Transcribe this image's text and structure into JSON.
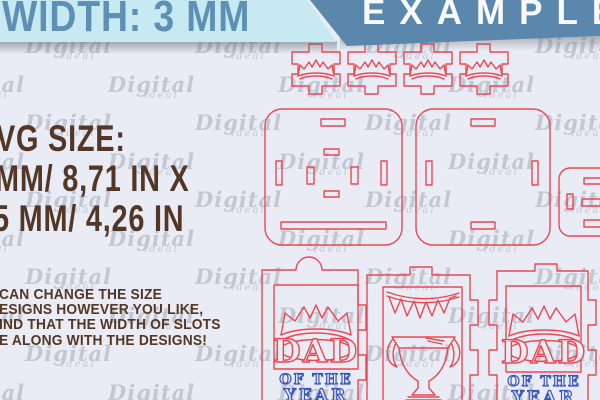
{
  "banners": {
    "width_label": "WIDTH: 3 MM",
    "example_label": "EXAMPLE"
  },
  "size_info": {
    "heading": "VG SIZE:",
    "dimension_line1": "MM/ 8,71 IN X",
    "dimension_line2": "5 MM/ 4,26 IN"
  },
  "note": {
    "line1": "CAN CHANGE THE SIZE",
    "line2": "ESIGNS HOWEVER YOU LIKE,",
    "line3": "IND THAT THE WIDTH OF SLOTS",
    "line4": "E ALONG WITH THE DESIGNS!"
  },
  "design_text": {
    "dad": "DAD",
    "of_the": "OF THE",
    "year": "YEAR"
  },
  "watermark": {
    "brand": "Digital",
    "sub": "ideal"
  },
  "colors": {
    "background": "#e9ecf4",
    "cut_line_red": "#ee4752",
    "accent_blue_text": "#3b57c2",
    "banner_cyan_bg": "#c7eaf2",
    "banner_cyan_text": "#5e90b5",
    "banner_blue_bg": "#5c87ac",
    "banner_blue_text": "#f7f9fa",
    "heading_brown": "#523726",
    "watermark_gray": "#8f96a5"
  }
}
